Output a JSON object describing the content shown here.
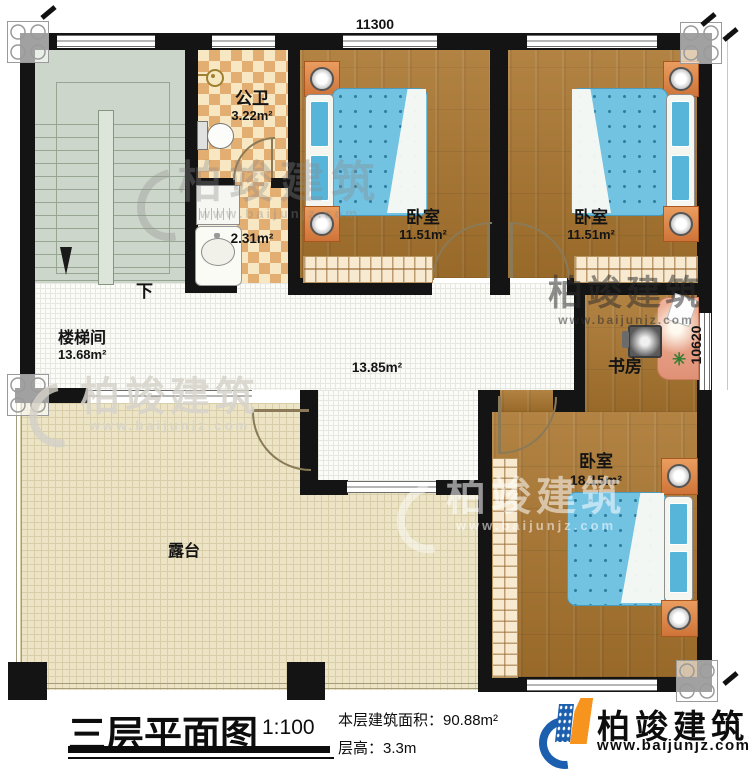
{
  "plan": {
    "dim_top": "11300",
    "dim_right": "10620",
    "rooms": {
      "stairwell": {
        "name": "楼梯间",
        "area": "13.68m²",
        "down": "下"
      },
      "bathroom": {
        "name": "公卫",
        "area": "3.22m²",
        "ante_area": "2.31m²"
      },
      "bedroom_top_left": {
        "name": "卧室",
        "area": "11.51m²"
      },
      "bedroom_top_right": {
        "name": "卧室",
        "area": "11.51m²"
      },
      "hall": {
        "area": "13.85m²"
      },
      "study": {
        "name": "书房"
      },
      "bedroom_south": {
        "name": "卧室",
        "area": "18.15m²"
      },
      "terrace": {
        "name": "露台"
      }
    }
  },
  "footer": {
    "title": "三层平面图",
    "scale": "1:100",
    "area_line": "本层建筑面积：90.88m²",
    "floor_height_line": "层高：3.3m"
  },
  "brand": {
    "name": "柏竣建筑",
    "site": "www.baijunjz.com"
  },
  "colors": {
    "wall": "#141414",
    "wood": "#a9752e",
    "bed_blue": "#72c2e2",
    "checker": "#e3ae72",
    "terrace": "#ece4c5",
    "brand_blue": "#1c5fae",
    "brand_orange": "#f7941d"
  }
}
